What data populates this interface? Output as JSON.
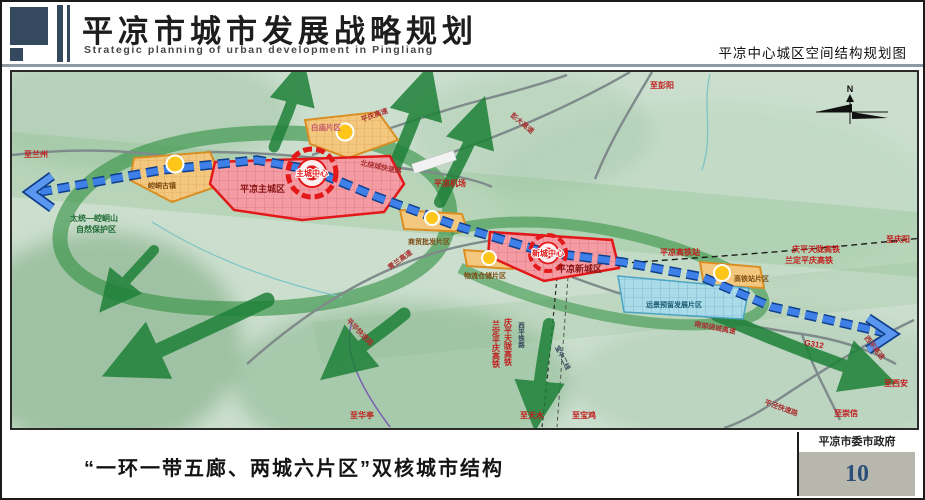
{
  "header": {
    "title": "平凉市城市发展战略规划",
    "subtitle": "Strategic planning of urban development in Pingliang",
    "map_title": "平凉中心城区空间结构规划图"
  },
  "footer": {
    "caption": "“一环一带五廊、两城六片区”双核城市结构",
    "agency": "平凉市委市政府",
    "page_number": "10"
  },
  "map": {
    "compass_label": "N",
    "zones": {
      "main_city": "平凉主城区",
      "new_city": "平凉新城区",
      "main_core": "主城中心",
      "new_core": "新城中心",
      "baimiao": "白庙片区",
      "kongtong_town": "崆峒古镇",
      "trade": "商贸批发片区",
      "logistics": "物流仓储片区",
      "hsr_station_area": "高铁站片区",
      "reserved": "远景预留发展片区",
      "nature_reserve_line1": "太统—崆峒山",
      "nature_reserve_line2": "自然保护区"
    },
    "stations": {
      "hsr_station": "平凉高铁站",
      "airport": "平凉机场"
    },
    "roads": {
      "pingqing_expwy": "平庆高速",
      "pengda_expwy": "彭大高速",
      "north_ring": "北绕城快速路",
      "qinglan_expwy": "青兰高速",
      "south_ring": "南部绕城高速",
      "pinghua_expwy": "平华快速路",
      "pingjing_expwy": "平泾快速路",
      "xiping_expwy": "西平高速",
      "g312": "G312"
    },
    "rails": {
      "qptl_hsr": "庆平天陇高铁",
      "ldpq_hsr": "兰定平庆高铁",
      "qptl_hsr_v": "庆平天陇高铁",
      "ldpq_hsr_v": "兰定平庆高铁",
      "xiping_rail": "西平铁路",
      "baozhong2": "宝中二线"
    },
    "directions": {
      "lanzhou": "至兰州",
      "pengyang": "至彭阳",
      "qingyang": "至庆阳",
      "huating": "至华亭",
      "tianshui": "至天水",
      "baoji": "至宝鸡",
      "xian": "至西安",
      "chongxin": "至崇信"
    },
    "colors": {
      "axis_blue": "#3f7fe8",
      "corridor_green": "#1e8038",
      "zone_red": "#e31919",
      "zone_orange": "#d98f23",
      "zone_blue": "#49a5c2",
      "node_yellow": "#ffc61a"
    }
  }
}
